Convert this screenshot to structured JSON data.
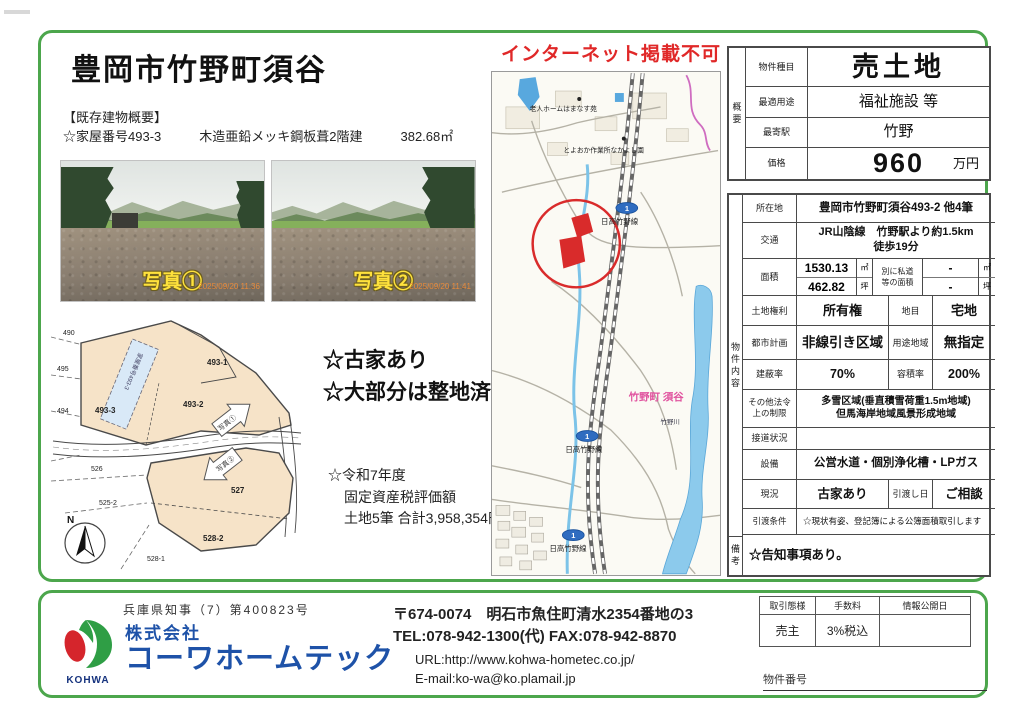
{
  "notice": "インターネット掲載不可",
  "title": "豊岡市竹野町須谷",
  "building": {
    "heading": "【既存建物概要】",
    "house_no": "☆家屋番号493-3",
    "structure": "木造亜鉛メッキ鋼板葺2階建",
    "floor_area": "382.68㎡"
  },
  "photos": {
    "p1_label": "写真①",
    "p1_time": "2025/09/20 11:36",
    "p2_label": "写真②",
    "p2_time": "2025/09/20 11:41"
  },
  "site_notes": {
    "note1": "☆古家あり",
    "note2": "☆大部分は整地済み！",
    "tax_line1": "☆令和7年度",
    "tax_line2": "固定資産税評価額",
    "tax_line3": "土地5筆  合計3,958,354円"
  },
  "cadastral": {
    "p490": "490",
    "p495": "495",
    "p494": "494",
    "p4933": "493-3",
    "p4931": "493-1",
    "p4932": "493-2",
    "p526": "526",
    "p5252": "525-2",
    "p527": "527",
    "p5281": "528-1",
    "p5282": "528-2",
    "building_label": "家屋番号493-3",
    "arrow1": "写真①",
    "arrow2": "写真②",
    "compass": "N"
  },
  "map": {
    "facility1": "老人ホームはまなす苑",
    "facility2": "とよおか作業所なかよし園",
    "area_label": "竹野町 須谷",
    "river_label": "竹野川",
    "route_no": "1",
    "route_name": "日高竹野線"
  },
  "summary": {
    "section": "概要",
    "r0_label": "物件種目",
    "r0_value": "売土地",
    "r1_label": "最適用途",
    "r1_value": "福祉施設 等",
    "r2_label": "最寄駅",
    "r2_value": "竹野",
    "r3_label": "価格",
    "r3_value": "960",
    "r3_unit": "万円"
  },
  "details": {
    "section": "物件内容",
    "location_label": "所在地",
    "location": "豊岡市竹野町須谷493-2 他4筆",
    "access_label": "交通",
    "access": "JR山陰線　竹野駅より約1.5km\n徒歩19分",
    "area_label": "面積",
    "area_m2": "1530.13",
    "area_m2_unit": "㎡",
    "area_tsubo": "462.82",
    "area_tsubo_unit": "坪",
    "private_road_label": "別に私道\n等の面積",
    "private_m2": "-",
    "private_m2_unit": "㎡",
    "private_tsubo": "-",
    "private_tsubo_unit": "坪",
    "rights_label": "土地権利",
    "rights": "所有権",
    "chimoku_label": "地目",
    "chimoku": "宅地",
    "plan_label": "都市計画",
    "plan": "非線引き区域",
    "zone_label": "用途地域",
    "zone": "無指定",
    "bcr_label": "建蔽率",
    "bcr": "70%",
    "far_label": "容積率",
    "far": "200%",
    "other_law_label": "その他法令\n上の制限",
    "other_law": "多雪区域(垂直積雪荷重1.5m地域)\n但馬海岸地域風景形成地域",
    "road_label": "接道状況",
    "road": "",
    "setsubi_label": "設備",
    "setsubi": "公営水道・個別浄化槽・LPガス",
    "genkyo_label": "現況",
    "genkyo": "古家あり",
    "hikiwatashi_label": "引渡し日",
    "hikiwatashi": "ご相談",
    "joken_label": "引渡条件",
    "joken": "☆現状有姿、登記簿による公簿面積取引します",
    "biko_section": "備考",
    "biko": "☆告知事項あり。"
  },
  "footer": {
    "license": "兵庫県知事（7）第400823号",
    "logo_text": "KOHWA",
    "company_prefix": "株式会社",
    "company_name": "コーワホームテック",
    "address": "〒674-0074　明石市魚住町清水2354番地の3",
    "tel_fax": "TEL:078-942-1300(代)  FAX:078-942-8870",
    "url": "URL:http://www.kohwa-hometec.co.jp/",
    "email": "E-mail:ko-wa@ko.plamail.jp",
    "deal_h1": "取引態様",
    "deal_h2": "手数料",
    "deal_h3": "情報公開日",
    "deal_v1": "売主",
    "deal_v2": "3%税込",
    "deal_v3": "",
    "property_no_label": "物件番号"
  }
}
